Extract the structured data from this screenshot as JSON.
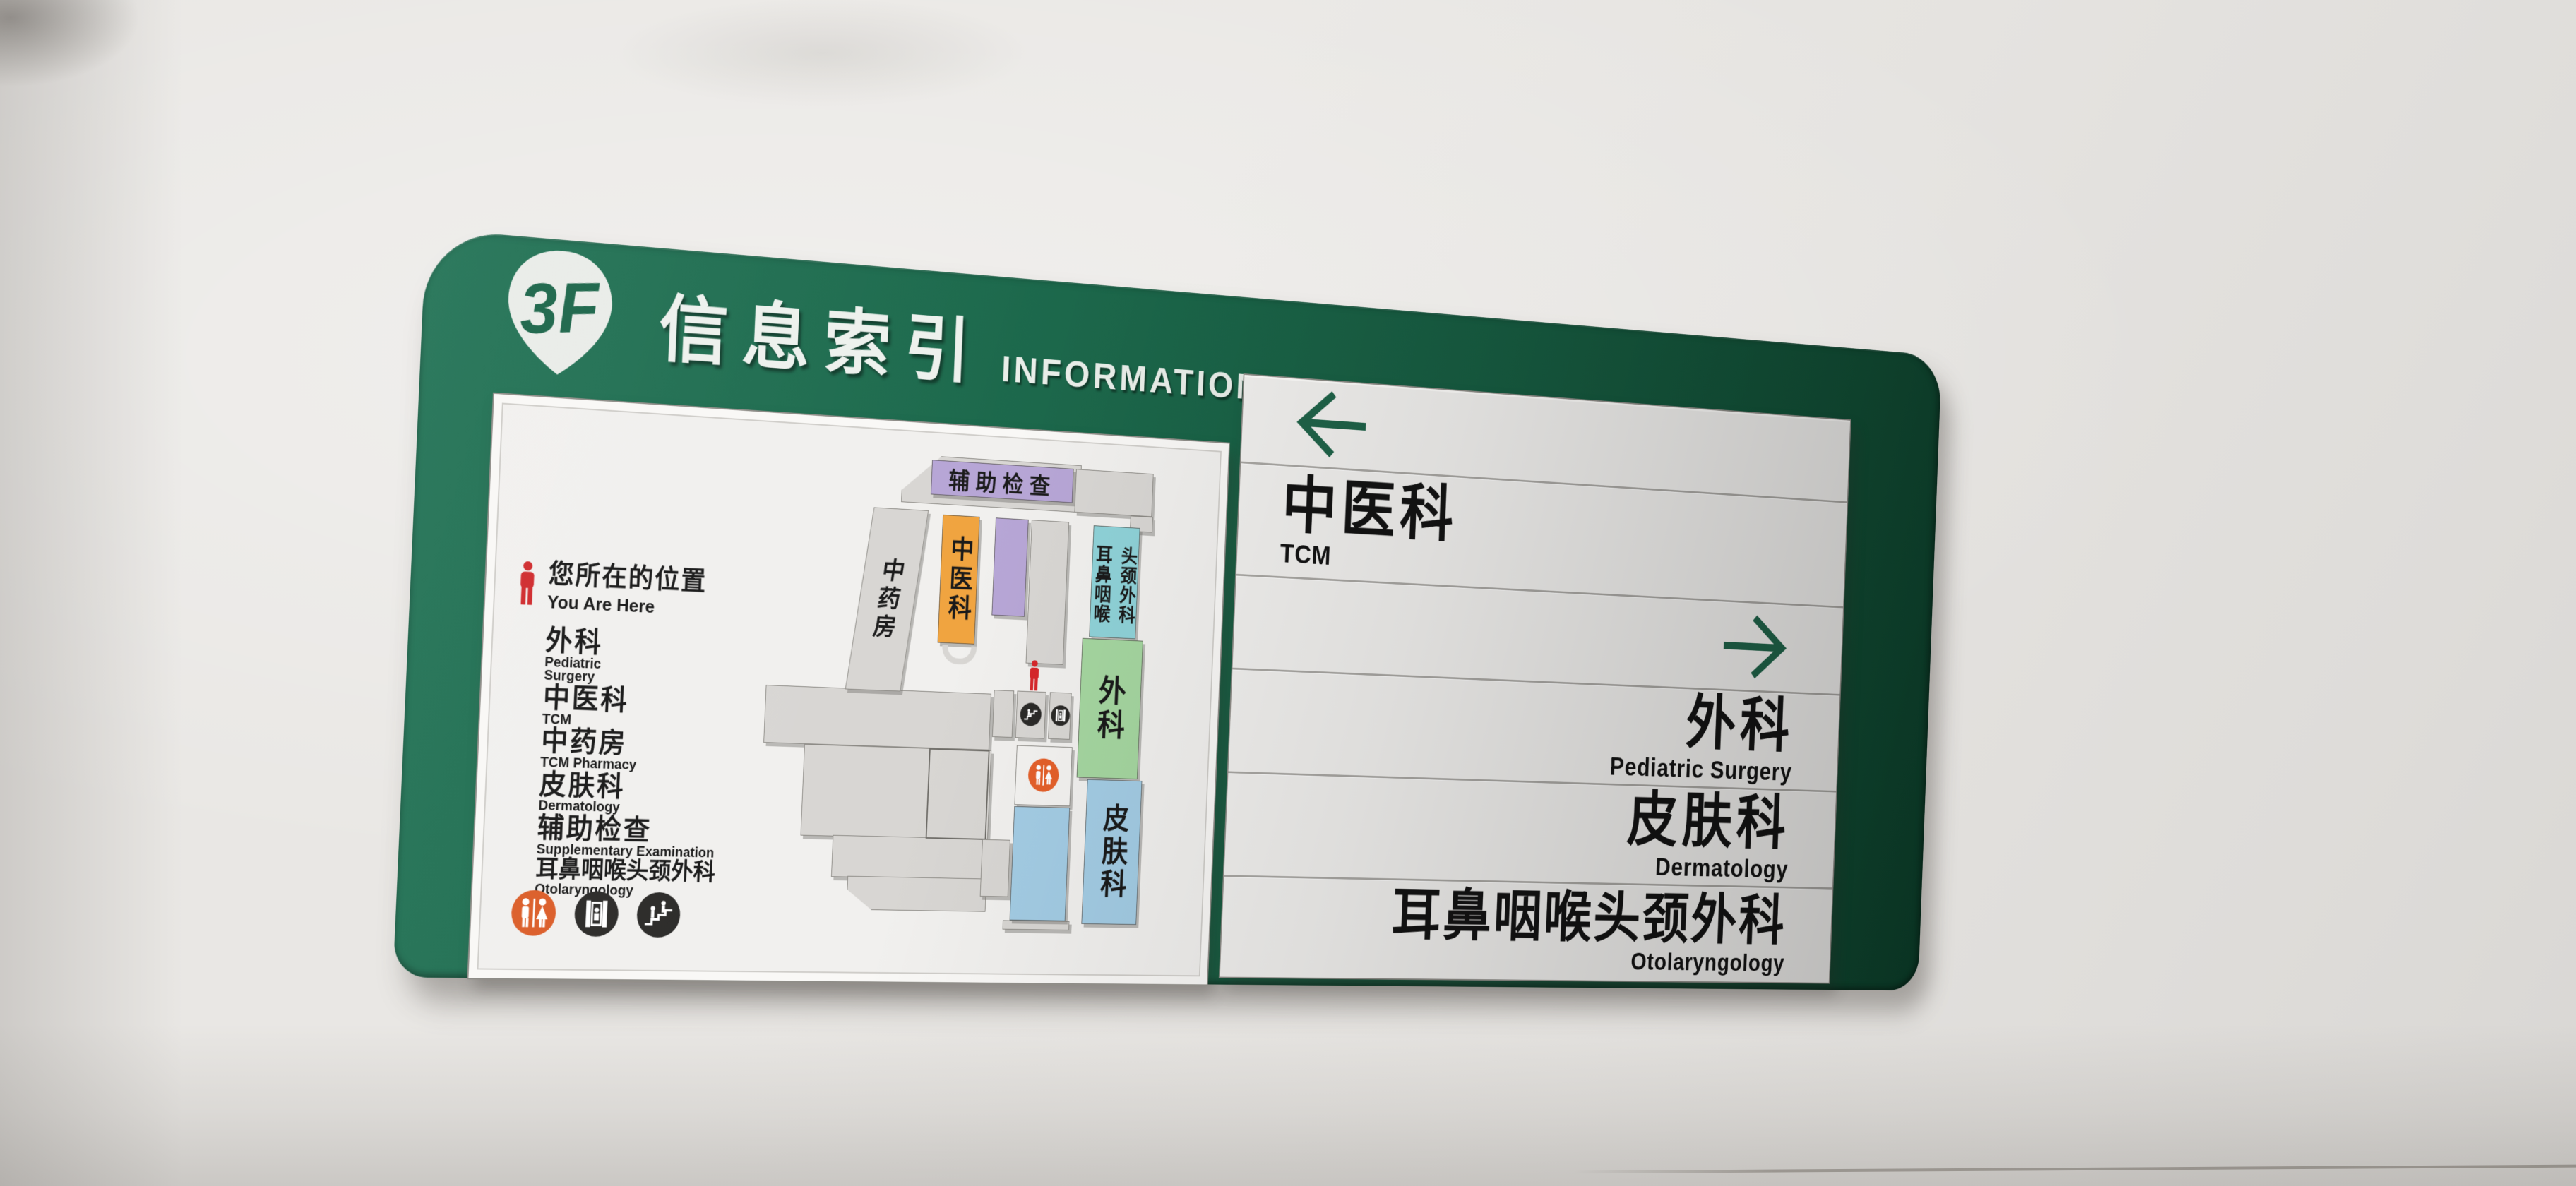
{
  "sign": {
    "floor_badge": "3F",
    "title_cn": "信息索引",
    "title_en": "INFORMATION"
  },
  "map_panel": {
    "you_are_here": {
      "cn": "您所在的位置",
      "en": "You Are Here"
    },
    "legend": [
      {
        "cn": "外科",
        "en": "Pediatric Surgery"
      },
      {
        "cn": "中医科",
        "en": "TCM"
      },
      {
        "cn": "中药房",
        "en": "TCM Pharmacy"
      },
      {
        "cn": "皮肤科",
        "en": "Dermatology"
      },
      {
        "cn": "辅助检查",
        "en": "Supplementary Examination"
      },
      {
        "cn": "耳鼻咽喉头颈外科",
        "en": "Otolaryngology"
      }
    ],
    "blocks": {
      "aux_exam": "辅助检查",
      "tcm_pharmacy": "中药房",
      "tcm": "中医科",
      "ent_col_left": "耳鼻咽喉",
      "ent_col_right": "头颈外科",
      "surgery": "外科",
      "dermatology": "皮肤科"
    },
    "facility_icons": [
      "restroom",
      "elevator",
      "stairs"
    ]
  },
  "directory": {
    "rows": [
      {
        "type": "arrow",
        "direction": "left"
      },
      {
        "type": "dept",
        "cn": "中医科",
        "en": "TCM",
        "align": "left"
      },
      {
        "type": "arrow",
        "direction": "right"
      },
      {
        "type": "dept",
        "cn": "外科",
        "en": "Pediatric Surgery",
        "align": "right"
      },
      {
        "type": "dept",
        "cn": "皮肤科",
        "en": "Dermatology",
        "align": "right"
      },
      {
        "type": "dept",
        "cn": "耳鼻咽喉头颈外科",
        "en": "Otolaryngology",
        "align": "right"
      }
    ]
  },
  "colors": {
    "board_green": "#1b6549",
    "arrow_green": "#1f6349",
    "block_orange": "#f0a440",
    "block_lavender": "#b7a6d6",
    "block_cyan": "#8fd2d8",
    "block_green": "#a5d6a0",
    "block_blue": "#a3cce4",
    "block_gray": "#d8d6d3",
    "marker_red": "#cf2a2d",
    "restroom_orange": "#db5d28"
  }
}
